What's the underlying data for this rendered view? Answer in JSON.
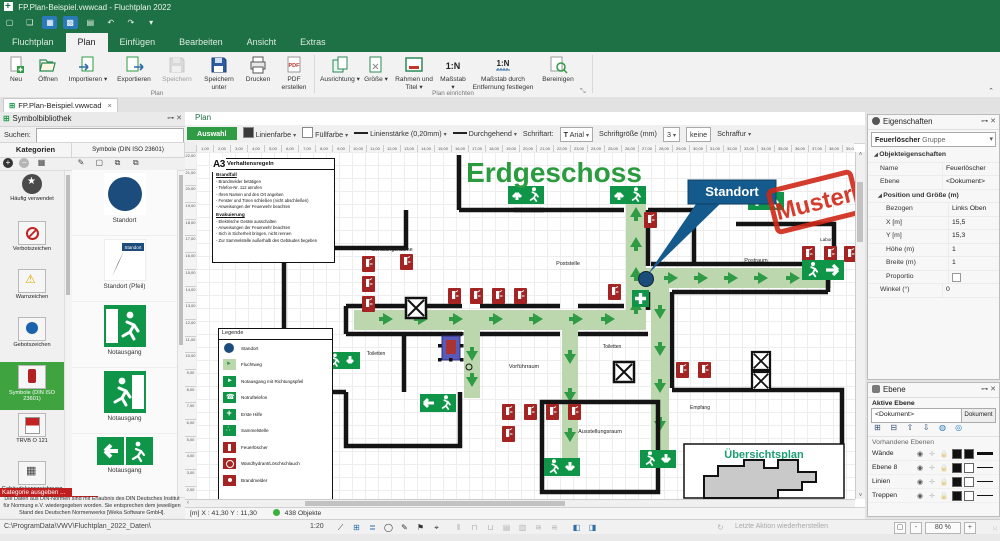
{
  "window": {
    "title": "FP.Plan-Beispiel.vwwcad - Fluchtplan 2022"
  },
  "ribbon": {
    "tabs": [
      "Fluchtplan",
      "Plan",
      "Einfügen",
      "Bearbeiten",
      "Ansicht",
      "Extras"
    ],
    "active_tab": "Plan",
    "pdf_icon_text": "PDF",
    "scale_icon_text": "1:N",
    "scale2_icon_text": "1:N",
    "groups": [
      {
        "label": "Plan",
        "buttons": [
          "Neu",
          "Öffnen",
          "Importieren",
          "Exportieren",
          "Speichern",
          "Speichern unter",
          "Drucken",
          "PDF erstellen"
        ]
      },
      {
        "label": "Plan einrichten",
        "buttons": [
          "Ausrichtung",
          "Größe",
          "Rahmen und Titel",
          "Maßstab",
          "Maßstab durch Entfernung festlegen",
          "Bereinigen"
        ]
      }
    ]
  },
  "document_tab": {
    "label": "FP.Plan-Beispiel.vwwcad",
    "close": "×"
  },
  "symbol_library": {
    "title": "Symbolbibliothek",
    "search_label": "Suchen:",
    "categories_header": "Kategorien",
    "symbols_header": "Symbole (DIN ISO 23601)",
    "categories": [
      {
        "label": "Häufig verwendet",
        "icon": "star"
      },
      {
        "label": "Verbotszeichen",
        "icon": "verbot"
      },
      {
        "label": "Warnzeichen",
        "icon": "warn"
      },
      {
        "label": "Gebotszeichen",
        "icon": "gebot"
      },
      {
        "label": "Symbole (DIN ISO 23601)",
        "icon": "din",
        "cls": "selected"
      },
      {
        "label": "TRVB O 121",
        "icon": "trvb"
      },
      {
        "label": "Gebäudekennzeichnung",
        "icon": "gebaeude"
      },
      {
        "label": "Hinweiszeichen",
        "icon": "hinweis"
      }
    ],
    "badge": "Kategorie ausgeben ...",
    "symbols": [
      "Standort",
      "Standort (Pfeil)",
      "Notausgang",
      "Notausgang",
      "Notausgang",
      "Notausgang"
    ],
    "symbol_arrow_label": "Standort",
    "disclaimer": "Die Daten aus DIN-Normen sind mit Erlaubnis des DIN Deutsches Institut für Normung e.V. wiedergegeben worden. Sie entsprechen dem jeweiligen Stand des Deutschen Normenwerks [Weka Software GmbH]."
  },
  "view_tab": "Plan",
  "toolbar": {
    "select": "Auswahl",
    "line_color": "Linienfarbe",
    "fill_color": "Füllfarbe",
    "line_width": "Linienstärke (0,20mm)",
    "line_style": "Durchgehend",
    "font_label": "Schriftart:",
    "font": "Arial",
    "font_size_label": "Schriftgröße (mm)",
    "font_size": "3",
    "hatch_value": "keine",
    "hatch_label": "Schraffur"
  },
  "rulers": {
    "h": [
      "1,00",
      "2,00",
      "3,00",
      "4,00",
      "5,00",
      "6,00",
      "7,00",
      "8,00",
      "9,00",
      "10,00",
      "11,00",
      "12,00",
      "13,00",
      "14,00",
      "15,00",
      "16,00",
      "17,00",
      "18,00",
      "19,00",
      "20,00",
      "21,00",
      "22,00",
      "23,00",
      "24,00",
      "25,00",
      "26,00",
      "27,00",
      "28,00",
      "29,00",
      "30,00",
      "31,00",
      "32,00",
      "33,00",
      "34,00",
      "35,00",
      "36,00",
      "37,00",
      "38,00",
      "39,00",
      "40,00",
      "41,00"
    ],
    "v": [
      "22,00",
      "21,00",
      "20,00",
      "19,00",
      "18,00",
      "17,00",
      "16,00",
      "15,00",
      "14,00",
      "13,00",
      "12,00",
      "11,00",
      "10,00",
      "9,00",
      "8,00",
      "7,00",
      "6,00",
      "5,00",
      "4,00",
      "3,00",
      "2,00",
      "1,00"
    ]
  },
  "plan": {
    "title": "Erdgeschoss",
    "page_marker": "A3",
    "stamp": "Muster",
    "callout": "Standort",
    "rules": {
      "title": "Verhaltensregeln",
      "sections": [
        {
          "title": "Brandfall",
          "items": [
            "- Brandmelder betätigen",
            "- Telefon-Nr. 112 anrufen",
            "- Ihren Namen und den Ort angeben",
            "- Fenster und Türen schließen (nicht abschließen)",
            "- Anweisungen der Feuerwehr beachten"
          ]
        },
        {
          "title": "Evakuierung",
          "items": [
            "- Elektrische Geräte ausschalten",
            "- Anweisungen der Feuerwehr beachten",
            "- Sich in Sicherheit bringen, nicht rennen",
            "- Zur Sammelstelle außerhalb des Gebäudes begeben"
          ]
        }
      ]
    },
    "legend": {
      "title": "Legende",
      "items": [
        {
          "label": "Standort",
          "icon": "standort"
        },
        {
          "label": "Fluchtweg",
          "icon": "fluchtweg"
        },
        {
          "label": "Notausgang mit Richtungspfeil",
          "icon": "notausgang"
        },
        {
          "label": "Notruftelefon",
          "icon": "telefon"
        },
        {
          "label": "Erste Hilfe",
          "icon": "erstehilfe"
        },
        {
          "label": "Sammelstelle",
          "icon": "sammelstelle"
        },
        {
          "label": "Feuerlöscher",
          "icon": "feuerloescher"
        },
        {
          "label": "Wandhydrant/Löschschlauch",
          "icon": "hydrant"
        },
        {
          "label": "Brandmelder",
          "icon": "brandmelder"
        }
      ]
    },
    "rooms": [
      "Schulungsräume",
      "Poststelle",
      "Postraum",
      "Labor",
      "Toiletten",
      "Toiletten",
      "Vorführraum",
      "Ausstellungsraum",
      "Empfang"
    ],
    "overview_title": "Übersichtsplan"
  },
  "properties_panel": {
    "title": "Eigenschaften",
    "selector": {
      "main": "Feuerlöscher",
      "sub": "Gruppe"
    },
    "rows": [
      {
        "k": "Objekteigenschaften",
        "v": "",
        "cls": "group lvl1"
      },
      {
        "k": "Name",
        "v": "Feuerlöscher",
        "cls": "lvl2"
      },
      {
        "k": "Ebene",
        "v": "<Dokument>",
        "cls": "lvl2"
      },
      {
        "k": "Position und Größe (m)",
        "v": "",
        "cls": "group lvl2"
      },
      {
        "k": "Bezogen",
        "v": "Links Oben",
        "cls": "lvl3"
      },
      {
        "k": "X [m]",
        "v": "15,5",
        "cls": "lvl3"
      },
      {
        "k": "Y [m]",
        "v": "15,3",
        "cls": "lvl3"
      },
      {
        "k": "Höhe (m)",
        "v": "1",
        "cls": "lvl3"
      },
      {
        "k": "Breite (m)",
        "v": "1",
        "cls": "lvl3"
      },
      {
        "k": "Proportio",
        "v": "",
        "cls": "lvl3 check"
      },
      {
        "k": "Winkel (°)",
        "v": "0",
        "cls": "lvl2"
      }
    ]
  },
  "layers_panel": {
    "title": "Ebene",
    "active_label": "Aktive Ebene",
    "active_value": "<Dokument>",
    "doc_button": "Dokument",
    "list_label": "Vorhandene Ebenen",
    "layers": [
      {
        "name": "Wände",
        "cls": "sw2-black line-thick"
      },
      {
        "name": "Ebene 8",
        "cls": "sw2-white line-thin"
      },
      {
        "name": "Linien",
        "cls": "sw2-white line-thin"
      },
      {
        "name": "Treppen",
        "cls": "sw2-white line-thin"
      }
    ]
  },
  "canvas_status": {
    "coords": "[m]  X : 41,30  Y : 11,30",
    "objects": "438 Objekte"
  },
  "status_bar": {
    "path": "C:\\ProgramData\\VWV\\Fluchtplan_2022_Daten\\",
    "scale": "1:20",
    "last_action": "Letzte Aktion wiederherstellen",
    "zoom_value": "80 %",
    "zoom_minus": "-",
    "zoom_plus": "+"
  },
  "colors": {
    "chrome_green": "#1e7145",
    "exit_green": "#0f9548",
    "route_green": "#bcd6ae",
    "fire_red": "#a32422",
    "location_blue": "#1c4c7c",
    "stamp_red": "#d02818",
    "title_green": "#2b9b3f"
  }
}
